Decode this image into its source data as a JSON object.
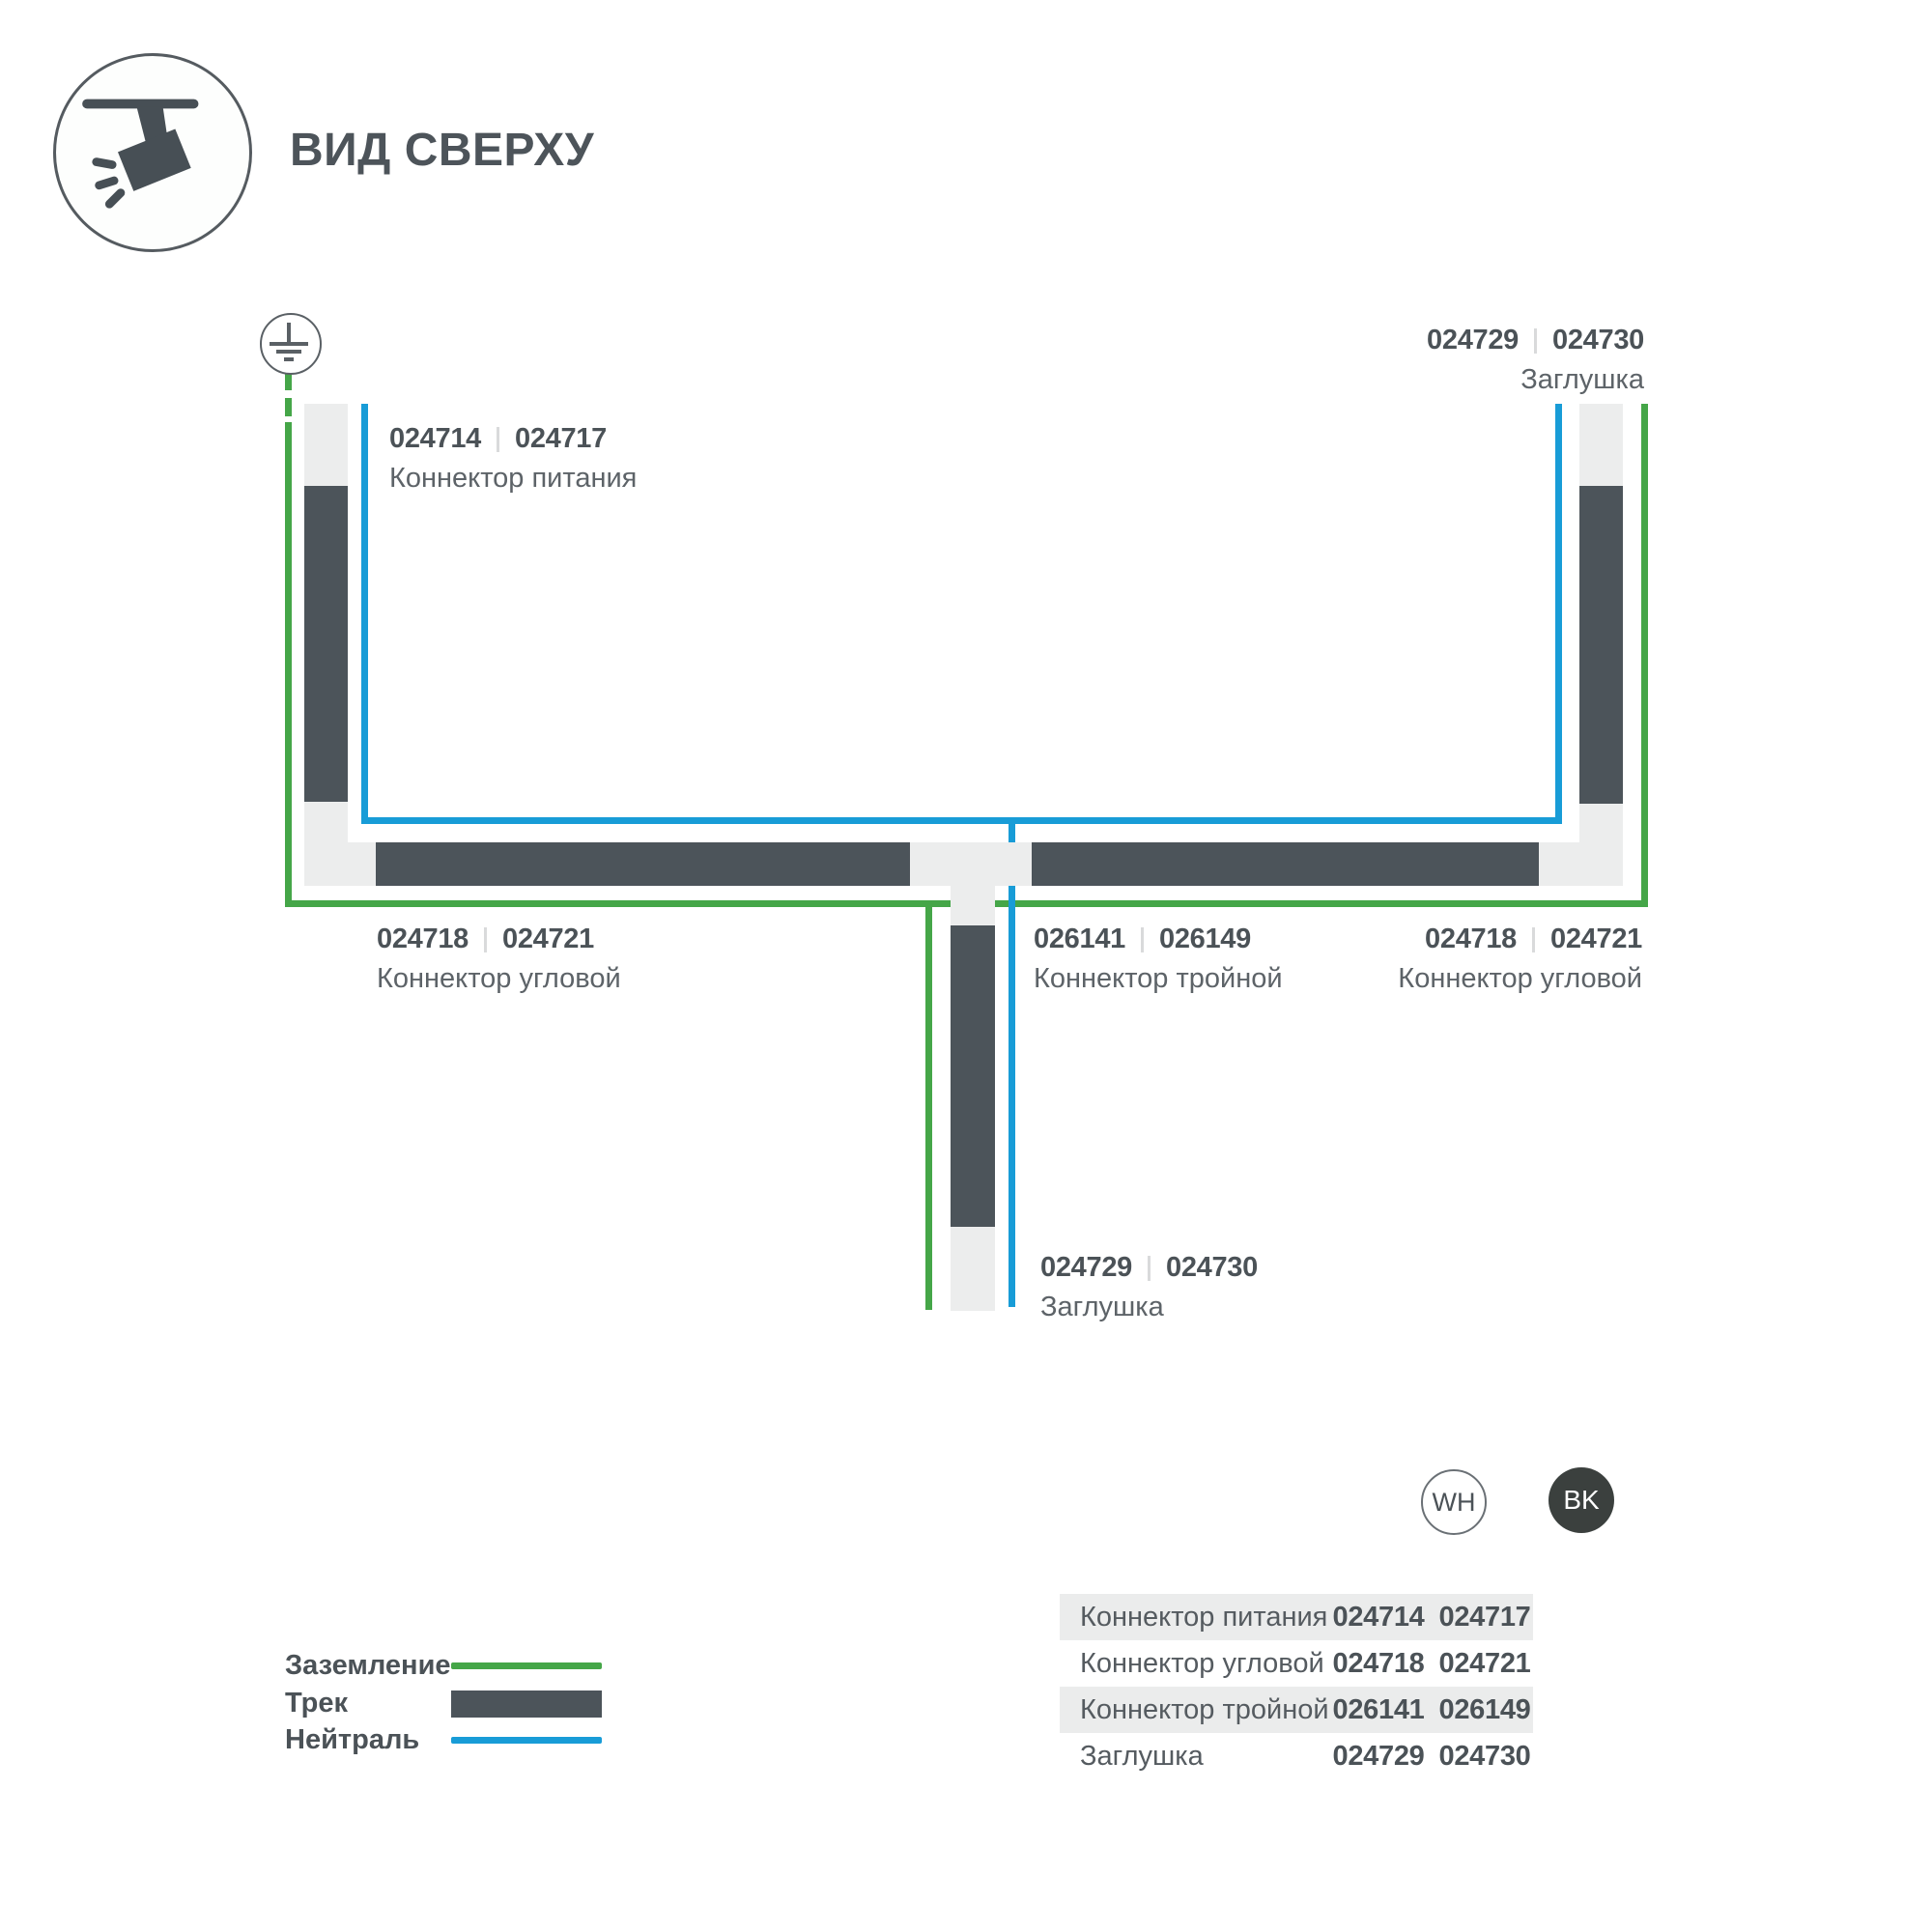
{
  "header": {
    "title": "ВИД СВЕРХУ"
  },
  "diagram": {
    "labels": {
      "power": {
        "code_wh": "024714",
        "code_bk": "024717",
        "name": "Коннектор питания"
      },
      "endcap_top": {
        "code_wh": "024729",
        "code_bk": "024730",
        "name": "Заглушка"
      },
      "corner_left": {
        "code_wh": "024718",
        "code_bk": "024721",
        "name": "Коннектор угловой"
      },
      "triple": {
        "code_wh": "026141",
        "code_bk": "026149",
        "name": "Коннектор тройной"
      },
      "corner_right": {
        "code_wh": "024718",
        "code_bk": "024721",
        "name": "Коннектор угловой"
      },
      "endcap_bottom": {
        "code_wh": "024729",
        "code_bk": "024730",
        "name": "Заглушка"
      }
    }
  },
  "legend": {
    "ground": "Заземление",
    "track": "Трек",
    "neutral": "Нейтраль"
  },
  "variants": {
    "white": "WH",
    "black": "BK"
  },
  "table": {
    "rows": [
      {
        "name": "Коннектор питания",
        "wh": "024714",
        "bk": "024717"
      },
      {
        "name": "Коннектор угловой",
        "wh": "024718",
        "bk": "024721"
      },
      {
        "name": "Коннектор тройной",
        "wh": "026141",
        "bk": "026149"
      },
      {
        "name": "Заглушка",
        "wh": "024729",
        "bk": "024730"
      }
    ]
  },
  "colors": {
    "track": "#4c545a",
    "track_housing": "#eceded",
    "ground_line": "#45a648",
    "neutral_line": "#189cd7"
  }
}
